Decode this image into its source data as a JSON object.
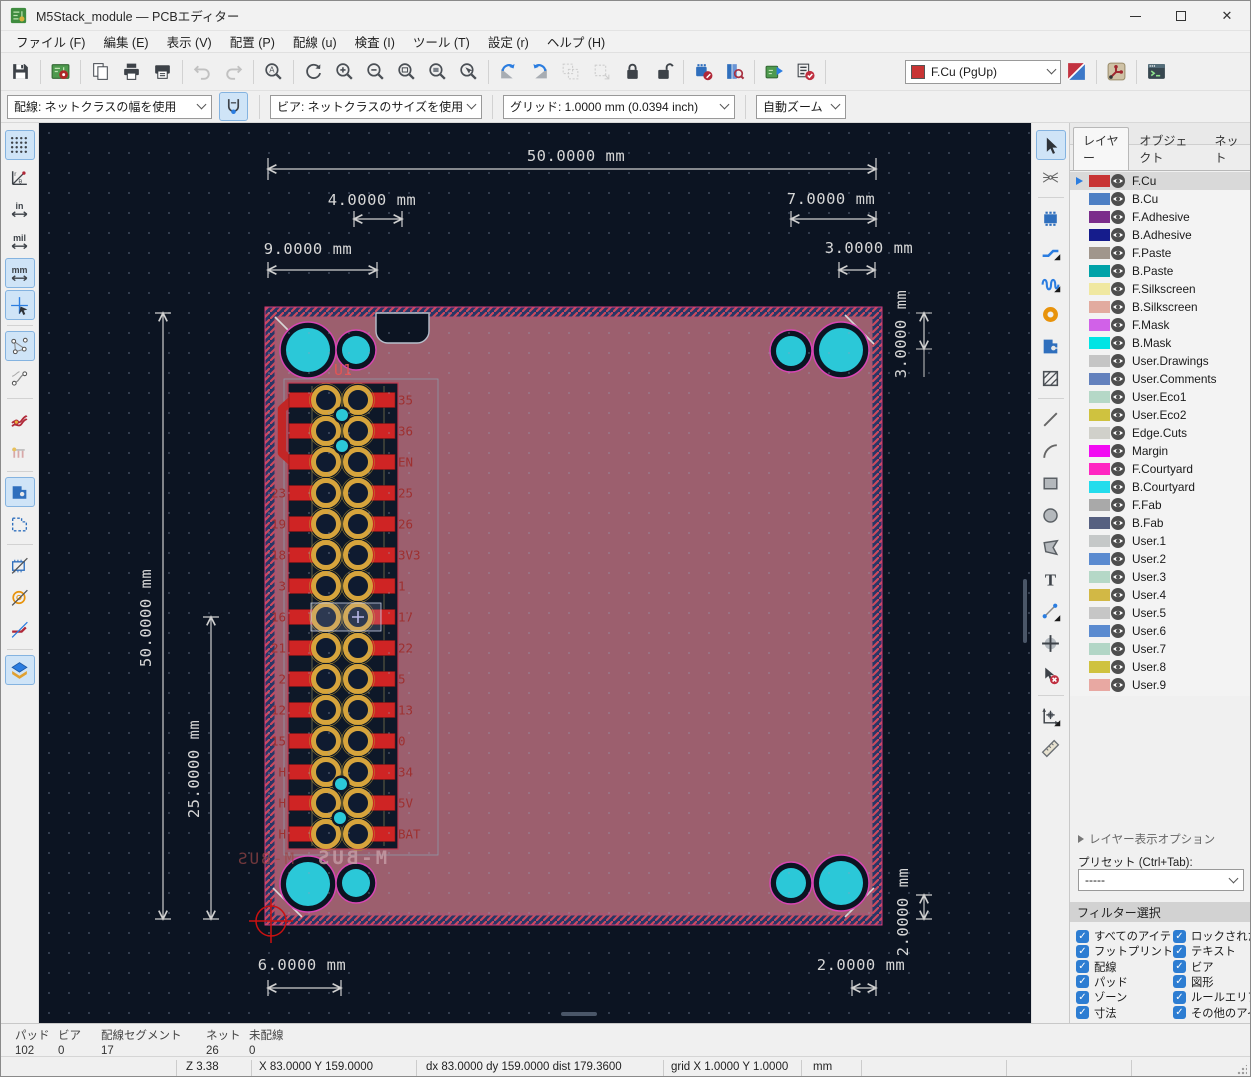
{
  "window": {
    "title": "M5Stack_module — PCBエディター"
  },
  "menubar": {
    "items": [
      "ファイル (F)",
      "編集 (E)",
      "表示 (V)",
      "配置 (P)",
      "配線 (u)",
      "検査 (I)",
      "ツール (T)",
      "設定 (r)",
      "ヘルプ (H)"
    ]
  },
  "toolbar_main": {
    "items": [
      {
        "t": "b",
        "n": "save"
      },
      {
        "t": "s"
      },
      {
        "t": "b",
        "n": "board-setup"
      },
      {
        "t": "s"
      },
      {
        "t": "b",
        "n": "page-settings"
      },
      {
        "t": "b",
        "n": "print"
      },
      {
        "t": "b",
        "n": "plot"
      },
      {
        "t": "s"
      },
      {
        "t": "b",
        "n": "undo",
        "disabled": true
      },
      {
        "t": "b",
        "n": "redo",
        "disabled": true
      },
      {
        "t": "s"
      },
      {
        "t": "b",
        "n": "find"
      },
      {
        "t": "s"
      },
      {
        "t": "b",
        "n": "refresh-view"
      },
      {
        "t": "b",
        "n": "zoom-in"
      },
      {
        "t": "b",
        "n": "zoom-out"
      },
      {
        "t": "b",
        "n": "zoom-fit"
      },
      {
        "t": "b",
        "n": "zoom-fit-objects"
      },
      {
        "t": "b",
        "n": "zoom-selection"
      },
      {
        "t": "s"
      },
      {
        "t": "b",
        "n": "rotate-ccw"
      },
      {
        "t": "b",
        "n": "rotate-cw"
      },
      {
        "t": "b",
        "n": "group-items",
        "disabled": true
      },
      {
        "t": "b",
        "n": "ungroup-items",
        "disabled": true
      },
      {
        "t": "b",
        "n": "lock"
      },
      {
        "t": "b",
        "n": "unlock"
      },
      {
        "t": "s"
      },
      {
        "t": "b",
        "n": "footprint-editor"
      },
      {
        "t": "b",
        "n": "footprint-browser"
      },
      {
        "t": "s"
      },
      {
        "t": "b",
        "n": "update-pcb-from-schematic"
      },
      {
        "t": "b",
        "n": "design-rules-check"
      },
      {
        "t": "s"
      }
    ],
    "layer_selector": {
      "value": "F.Cu (PgUp)",
      "swatch": "#c83434"
    },
    "items_right": [
      {
        "t": "b",
        "n": "layer-pair"
      },
      {
        "t": "s"
      },
      {
        "t": "b",
        "n": "router-settings"
      },
      {
        "t": "s"
      },
      {
        "t": "b",
        "n": "scripting-console"
      }
    ]
  },
  "toolbar_params": {
    "track_width": "配線: ネットクラスの幅を使用",
    "via_size": "ビア: ネットクラスのサイズを使用",
    "grid": "グリッド: 1.0000 mm (0.0394 inch)",
    "zoom": "自動ズーム"
  },
  "left_toolbar": {
    "items": [
      {
        "t": "b",
        "n": "grid-visibility",
        "active": true
      },
      {
        "t": "b",
        "n": "polar-coordinates"
      },
      {
        "t": "b",
        "n": "units-inch"
      },
      {
        "t": "b",
        "n": "units-mil"
      },
      {
        "t": "b",
        "n": "units-mm",
        "active": true
      },
      {
        "t": "b",
        "n": "crosshair-cursor",
        "active": true
      },
      {
        "t": "s"
      },
      {
        "t": "b",
        "n": "show-ratsnest",
        "active": true
      },
      {
        "t": "b",
        "n": "curved-ratsnest"
      },
      {
        "t": "s"
      },
      {
        "t": "b",
        "n": "track-clearance-display"
      },
      {
        "t": "b",
        "n": "net-names-display"
      },
      {
        "t": "s"
      },
      {
        "t": "b",
        "n": "zone-fill-display",
        "active": true
      },
      {
        "t": "b",
        "n": "zone-outline-display"
      },
      {
        "t": "s"
      },
      {
        "t": "b",
        "n": "sketch-footprints"
      },
      {
        "t": "b",
        "n": "sketch-pads"
      },
      {
        "t": "b",
        "n": "sketch-tracks"
      },
      {
        "t": "s"
      },
      {
        "t": "b",
        "n": "appearance-manager",
        "active": true
      }
    ]
  },
  "right_toolbar": {
    "items": [
      {
        "t": "b",
        "n": "select-tool",
        "active": true
      },
      {
        "t": "b",
        "n": "local-ratsnest"
      },
      {
        "t": "s"
      },
      {
        "t": "b",
        "n": "place-footprint"
      },
      {
        "t": "b",
        "n": "route-tracks",
        "f": true
      },
      {
        "t": "b",
        "n": "tune-length",
        "f": true
      },
      {
        "t": "b",
        "n": "place-via"
      },
      {
        "t": "b",
        "n": "draw-zone"
      },
      {
        "t": "b",
        "n": "rule-area"
      },
      {
        "t": "s"
      },
      {
        "t": "b",
        "n": "draw-line"
      },
      {
        "t": "b",
        "n": "draw-arc"
      },
      {
        "t": "b",
        "n": "draw-rectangle"
      },
      {
        "t": "b",
        "n": "draw-circle"
      },
      {
        "t": "b",
        "n": "draw-polygon"
      },
      {
        "t": "b",
        "n": "add-text"
      },
      {
        "t": "b",
        "n": "dimension",
        "f": true
      },
      {
        "t": "b",
        "n": "target-marker"
      },
      {
        "t": "b",
        "n": "delete-tool"
      },
      {
        "t": "s"
      },
      {
        "t": "b",
        "n": "origin-tool",
        "f": true
      },
      {
        "t": "b",
        "n": "measure-tool"
      }
    ]
  },
  "appearance": {
    "title": "外観",
    "tabs": [
      {
        "label": "レイヤー",
        "active": true
      },
      {
        "label": "オブジェクト",
        "active": false
      },
      {
        "label": "ネット",
        "active": false
      }
    ],
    "layers": [
      {
        "name": "F.Cu",
        "color": "#c83434",
        "selected": true
      },
      {
        "name": "B.Cu",
        "color": "#4d7fc4"
      },
      {
        "name": "F.Adhesive",
        "color": "#7b2d8b"
      },
      {
        "name": "B.Adhesive",
        "color": "#151c8c"
      },
      {
        "name": "F.Paste",
        "color": "#a0968c"
      },
      {
        "name": "B.Paste",
        "color": "#00a2a8"
      },
      {
        "name": "F.Silkscreen",
        "color": "#f0e8a0"
      },
      {
        "name": "B.Silkscreen",
        "color": "#e2ab9f"
      },
      {
        "name": "F.Mask",
        "color": "#d161e8"
      },
      {
        "name": "B.Mask",
        "color": "#00e4e4"
      },
      {
        "name": "User.Drawings",
        "color": "#c5c5c5"
      },
      {
        "name": "User.Comments",
        "color": "#6381bd"
      },
      {
        "name": "User.Eco1",
        "color": "#b5d8c7"
      },
      {
        "name": "User.Eco2",
        "color": "#cfc23f"
      },
      {
        "name": "Edge.Cuts",
        "color": "#d0d0ca"
      },
      {
        "name": "Margin",
        "color": "#f20af2"
      },
      {
        "name": "F.Courtyard",
        "color": "#ff26c2"
      },
      {
        "name": "B.Courtyard",
        "color": "#23dcec"
      },
      {
        "name": "F.Fab",
        "color": "#a9a9a9"
      },
      {
        "name": "B.Fab",
        "color": "#566080"
      },
      {
        "name": "User.1",
        "color": "#c5c8c8"
      },
      {
        "name": "User.2",
        "color": "#5b8bd0"
      },
      {
        "name": "User.3",
        "color": "#b5d8c7"
      },
      {
        "name": "User.4",
        "color": "#d2b845"
      },
      {
        "name": "User.5",
        "color": "#c6c6c6"
      },
      {
        "name": "User.6",
        "color": "#5b8bd0"
      },
      {
        "name": "User.7",
        "color": "#b2d6c6"
      },
      {
        "name": "User.8",
        "color": "#cfc23f"
      },
      {
        "name": "User.9",
        "color": "#e8a8a2"
      }
    ],
    "layer_options_label": "レイヤー表示オプション",
    "preset_label": "プリセット (Ctrl+Tab):",
    "preset_value": "-----"
  },
  "filter": {
    "title": "フィルター選択",
    "items": [
      "すべてのアイテム",
      "ロックされたアイテム",
      "フットプリント",
      "テキスト",
      "配線",
      "ビア",
      "パッド",
      "図形",
      "ゾーン",
      "ルールエリア",
      "寸法",
      "その他のアイテム"
    ]
  },
  "status_counts": {
    "items": [
      {
        "label": "パッド",
        "value": "102"
      },
      {
        "label": "ビア",
        "value": "0"
      },
      {
        "label": "配線セグメント",
        "value": "17"
      },
      {
        "label": "ネット",
        "value": "26"
      },
      {
        "label": "未配線",
        "value": "0"
      }
    ]
  },
  "status_bar": {
    "zoom": "Z 3.38",
    "position": "X 83.0000 Y 159.0000",
    "delta": "dx 83.0000 dy 159.0000 dist 179.3600",
    "grid": "grid X 1.0000 Y 1.0000",
    "units": "mm"
  },
  "canvas": {
    "reference": "U1",
    "silk_text": "M-BUS",
    "silk_text_back": "M-BUS",
    "dims": {
      "top_width": "50.0000 mm",
      "top_a": "4.0000 mm",
      "top_b": "7.0000 mm",
      "top_c": "9.0000 mm",
      "top_d": "3.0000 mm",
      "right_top": "3.0000 mm",
      "left_height": "50.0000 mm",
      "left_half": "25.0000 mm",
      "bottom_a": "6.0000 mm",
      "bottom_b": "2.0000 mm",
      "right_bottom": "2.0000 mm"
    },
    "connector_rows": [
      {
        "l": "",
        "r": "35"
      },
      {
        "l": "",
        "r": "36"
      },
      {
        "l": "",
        "r": "EN"
      },
      {
        "l": "23",
        "r": "25"
      },
      {
        "l": "19",
        "r": "26"
      },
      {
        "l": "18",
        "r": "3V3"
      },
      {
        "l": "3",
        "r": "1"
      },
      {
        "l": "16",
        "r": "17"
      },
      {
        "l": "21",
        "r": "22"
      },
      {
        "l": "2",
        "r": "5"
      },
      {
        "l": "12",
        "r": "13"
      },
      {
        "l": "15",
        "r": "0"
      },
      {
        "l": "H",
        "r": "34"
      },
      {
        "l": "H",
        "r": "5V"
      },
      {
        "l": "H",
        "r": "BAT"
      }
    ],
    "colors": {
      "canvas_bg": "#0c1422",
      "board_zone": "#9c5f6e",
      "hole_cyan": "#2bc8d8",
      "pad_gold": "#d6a43c",
      "smd_red": "#cf2424",
      "dim_text": "#d6d6d6",
      "net_label": "#9e3030"
    }
  }
}
